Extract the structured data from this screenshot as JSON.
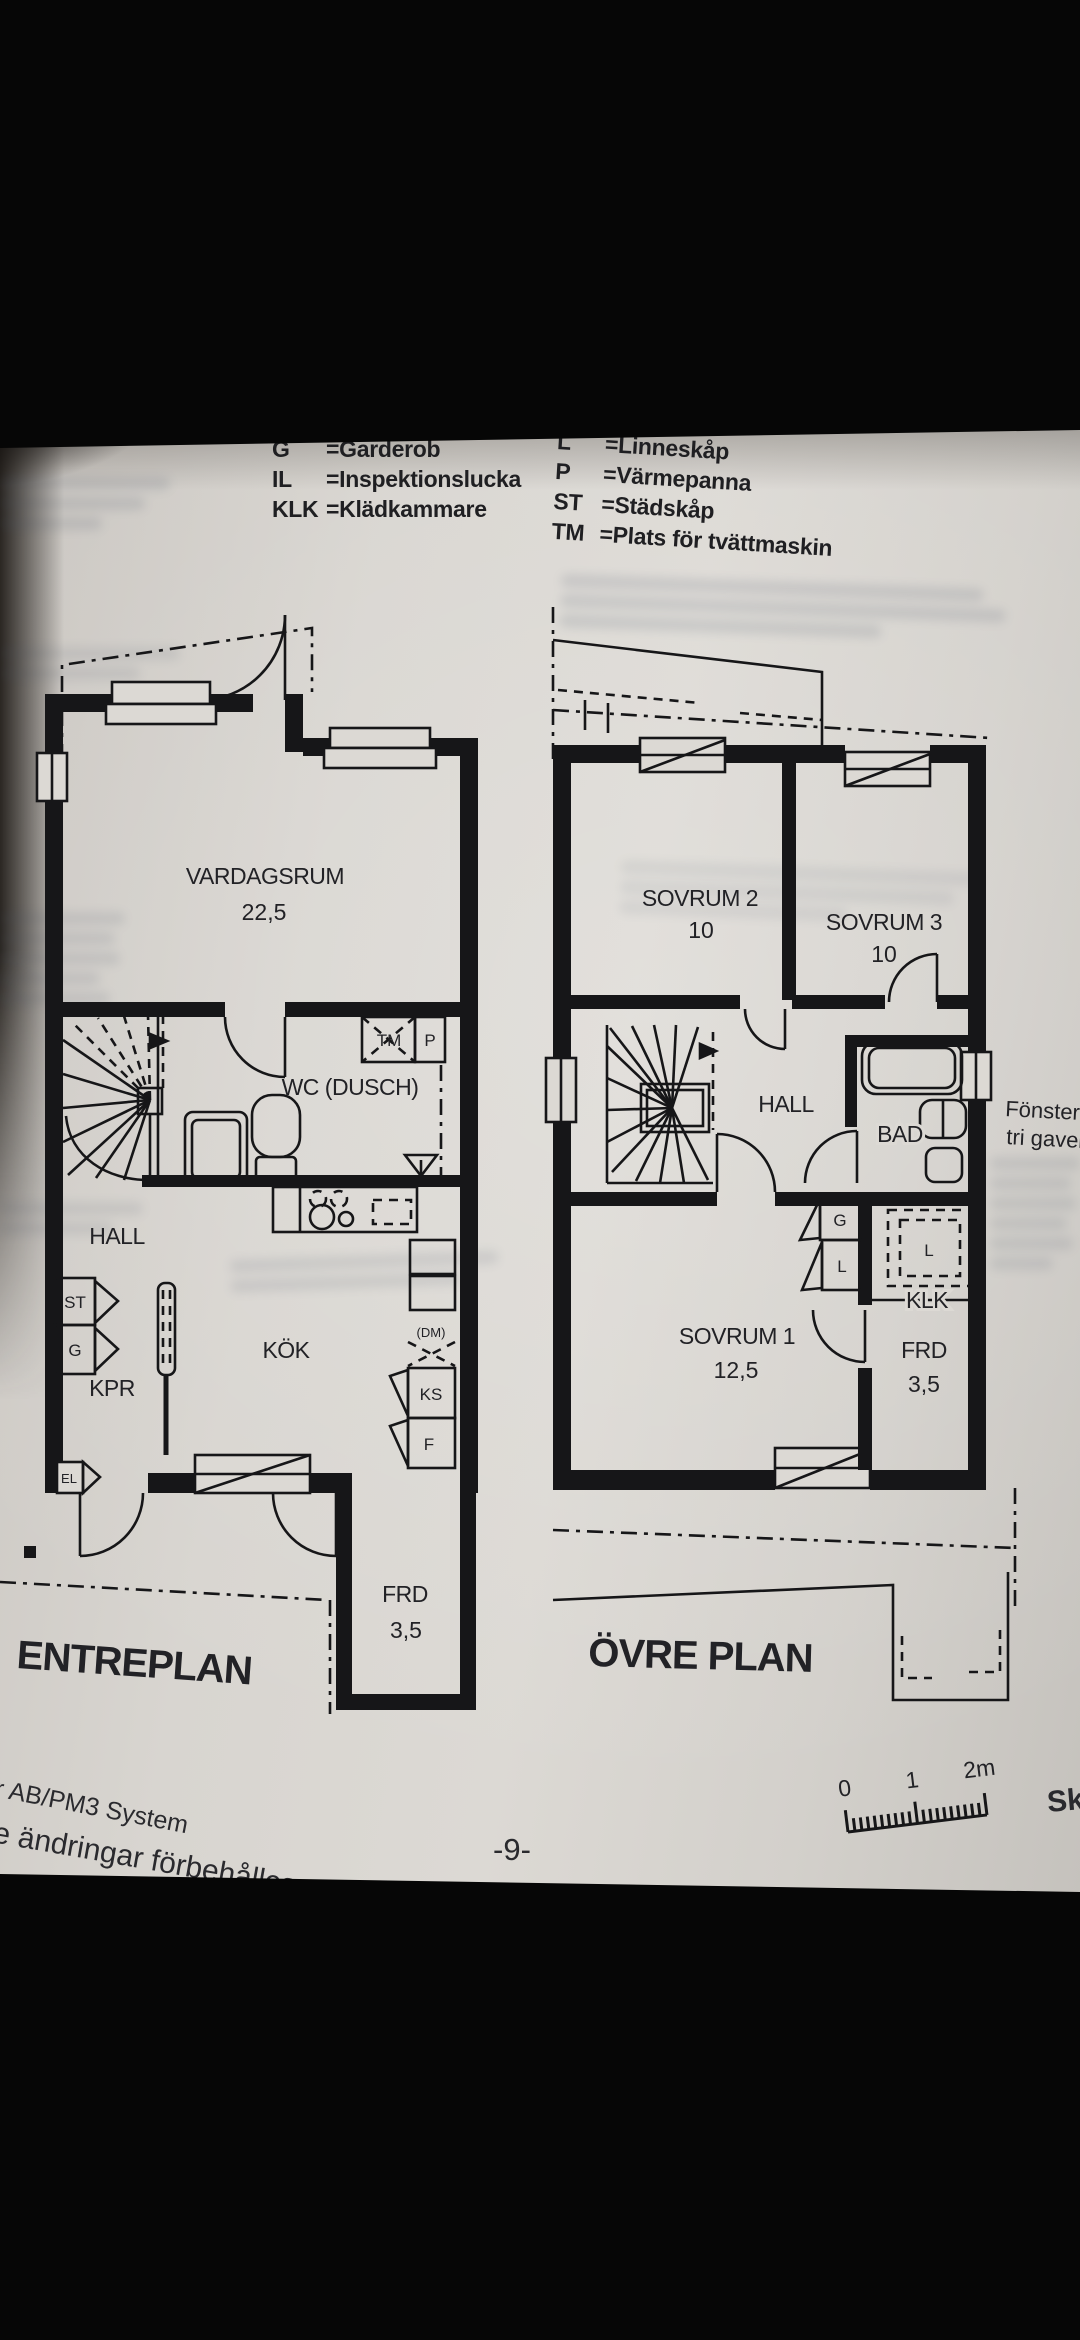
{
  "legend": {
    "left": [
      {
        "abbr": "G",
        "def": "=Garderob"
      },
      {
        "abbr": "IL",
        "def": "=Inspektionslucka"
      },
      {
        "abbr": "KLK",
        "def": "=Klädkammare"
      }
    ],
    "right": [
      {
        "abbr": "L",
        "def": "=Linneskåp"
      },
      {
        "abbr": "P",
        "def": "=Värmepanna"
      },
      {
        "abbr": "ST",
        "def": "=Städskåp"
      },
      {
        "abbr": "TM",
        "def": "=Plats för tvättmaskin"
      }
    ]
  },
  "entreplan": {
    "title": "ENTREPLAN",
    "rooms": {
      "vardagsrum": {
        "name": "VARDAGSRUM",
        "area": "22,5"
      },
      "wc": {
        "name": "WC (DUSCH)"
      },
      "hall": {
        "name": "HALL"
      },
      "kok": {
        "name": "KÖK"
      },
      "kpr": {
        "name": "KPR"
      },
      "frd": {
        "name": "FRD",
        "area": "3,5"
      }
    },
    "small_labels": {
      "tm": "TM",
      "p": "P",
      "st": "ST",
      "g": "G",
      "el": "EL",
      "ks": "KS",
      "f": "F",
      "dm": "(DM)"
    }
  },
  "ovre_plan": {
    "title": "ÖVRE PLAN",
    "rooms": {
      "sovrum2": {
        "name": "SOVRUM 2",
        "area": "10"
      },
      "sovrum3": {
        "name": "SOVRUM 3",
        "area": "10"
      },
      "hall": {
        "name": "HALL"
      },
      "bad": {
        "name": "BAD"
      },
      "klk": {
        "name": "KLK"
      },
      "sovrum1": {
        "name": "SOVRUM 1",
        "area": "12,5"
      },
      "frd": {
        "name": "FRD",
        "area": "3,5"
      }
    },
    "small_labels": {
      "g": "G",
      "l": "L",
      "l2": "L"
    },
    "annotation": {
      "line1": "Fönster vi",
      "line2": "tri gavel"
    }
  },
  "footer": {
    "line1": "r AB/PM3 System",
    "line2": "e ändringar förbehålles.",
    "page": "-9-",
    "scale": {
      "t0": "0",
      "t1": "1",
      "t2": "2m"
    },
    "right_cut": "Sk"
  }
}
